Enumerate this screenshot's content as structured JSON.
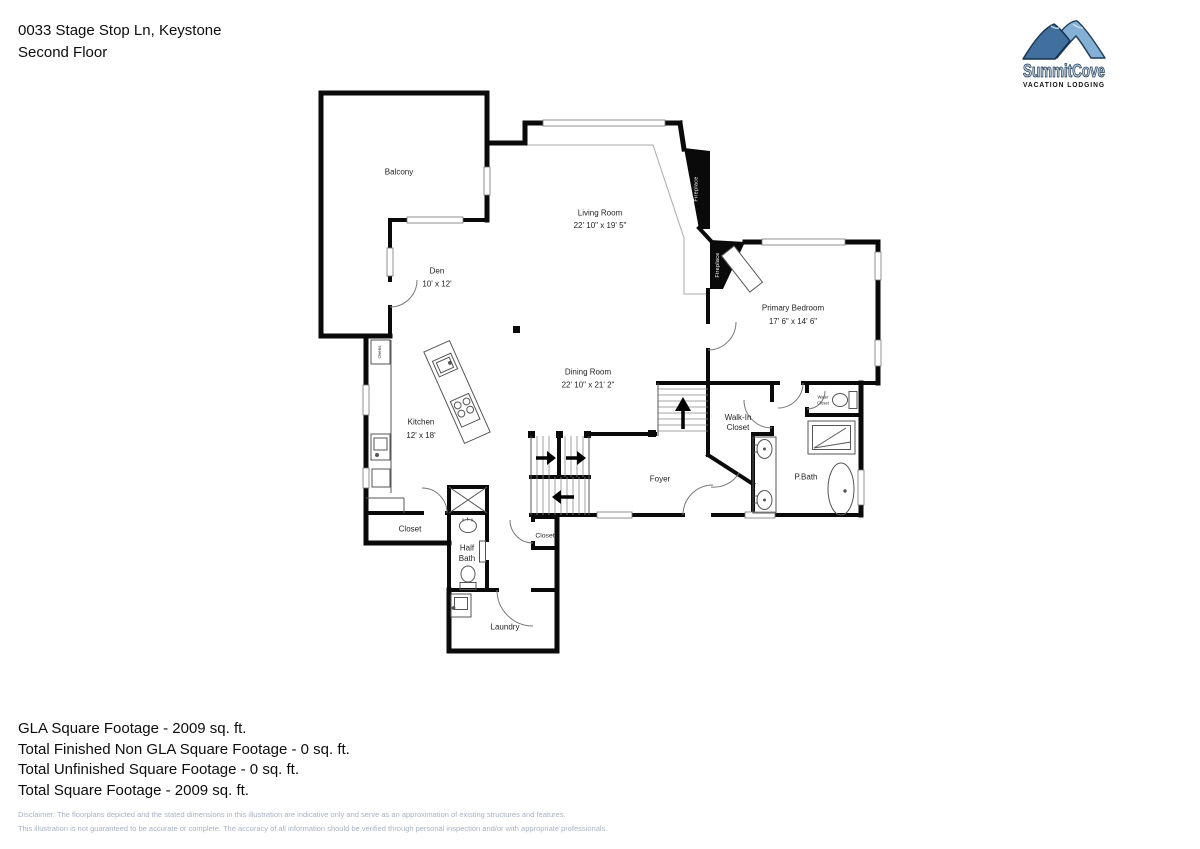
{
  "header": {
    "address": "0033 Stage Stop Ln, Keystone",
    "floor": "Second Floor"
  },
  "logo": {
    "brand": "SummitCove",
    "tagline": "VACATION LODGING",
    "colors": {
      "mountain_front": "#41709f",
      "mountain_back": "#84b0d5",
      "outline": "#1d3a57",
      "brand_text": "#bdd0da"
    }
  },
  "plan": {
    "rooms": {
      "balcony": {
        "name": "Balcony"
      },
      "living": {
        "name": "Living Room",
        "dims": "22' 10\" x 19' 5\""
      },
      "den": {
        "name": "Den",
        "dims": "10' x 12'"
      },
      "primary": {
        "name": "Primary Bedroom",
        "dims": "17' 6\" x 14' 6\""
      },
      "dining": {
        "name": "Dining Room",
        "dims": "22' 10\" x 21' 2\""
      },
      "kitchen": {
        "name": "Kitchen",
        "dims": "12' x 18'"
      },
      "walkin": {
        "line1": "Walk-In",
        "line2": "Closet"
      },
      "foyer": {
        "name": "Foyer"
      },
      "pbath": {
        "name": "P.Bath"
      },
      "closet1": {
        "name": "Closet"
      },
      "halfbath": {
        "line1": "Half",
        "line2": "Bath"
      },
      "closet2": {
        "name": "Closet"
      },
      "laundry": {
        "name": "Laundry"
      },
      "water_closet": {
        "line1": "Water",
        "line2": "Closet"
      },
      "fireplace_living": {
        "name": "Fireplace"
      },
      "fireplace_bedroom": {
        "name": "Fireplace"
      },
      "ovens": {
        "name": "Ovens"
      }
    }
  },
  "summary": {
    "lines": [
      "GLA Square Footage - 2009 sq. ft.",
      "Total Finished Non GLA Square Footage - 0 sq. ft.",
      "Total Unfinished Square Footage - 0 sq. ft.",
      "Total Square Footage - 2009 sq. ft."
    ]
  },
  "disclaimer": {
    "lines": [
      "Disclaimer: The floorplans depicted and the stated dimensions in this illustration are indicative only and serve as an approximation of existing structures and features.",
      "This illustration is not guaranteed to be accurate or complete. The accuracy of all information should be verified through personal inspection and/or with appropriate professionals."
    ]
  }
}
